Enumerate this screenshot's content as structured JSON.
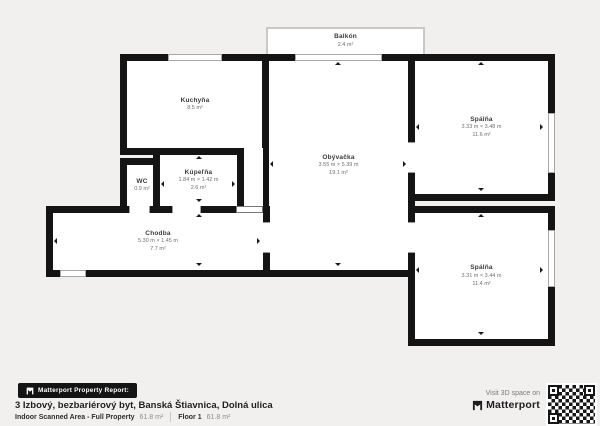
{
  "colors": {
    "background": "#f1f0ee",
    "wall": "#141414",
    "room_fill": "#ffffff",
    "brand_black": "#141414"
  },
  "rooms": {
    "balkon": {
      "name": "Balkón",
      "area": "2.4 m²"
    },
    "kuchyna": {
      "name": "Kuchyňa",
      "area": "8.5 m²"
    },
    "wc": {
      "name": "WC",
      "area": "0.9 m²"
    },
    "kupelna": {
      "name": "Kúpeľňa",
      "dims": "1.84 m × 1.42 m",
      "area": "2.6 m²"
    },
    "chodba": {
      "name": "Chodba",
      "dims": "5.30 m × 1.45 m",
      "area": "7.7 m²"
    },
    "obyvacka": {
      "name": "Obývačka",
      "dims": "3.55 m × 5.39 m",
      "area": "19.1 m²"
    },
    "spalna1": {
      "name": "Spálňa",
      "dims": "3.33 m × 3.48 m",
      "area": "11.6 m²"
    },
    "spalna2": {
      "name": "Spálňa",
      "dims": "3.31 m × 3.44 m",
      "area": "11.4 m²"
    }
  },
  "footer": {
    "badge_label": "Matterport Property Report:",
    "title": "3 Izbový, bezbariérový byt, Banská Štiavnica, Dolná ulica",
    "scanned_area_label": "Indoor Scanned Area - Full Property",
    "scanned_area_value": "61.8 m²",
    "floor_label": "Floor 1",
    "floor_value": "61.8 m²",
    "visit_text": "Visit 3D space on",
    "brand": "Matterport"
  }
}
